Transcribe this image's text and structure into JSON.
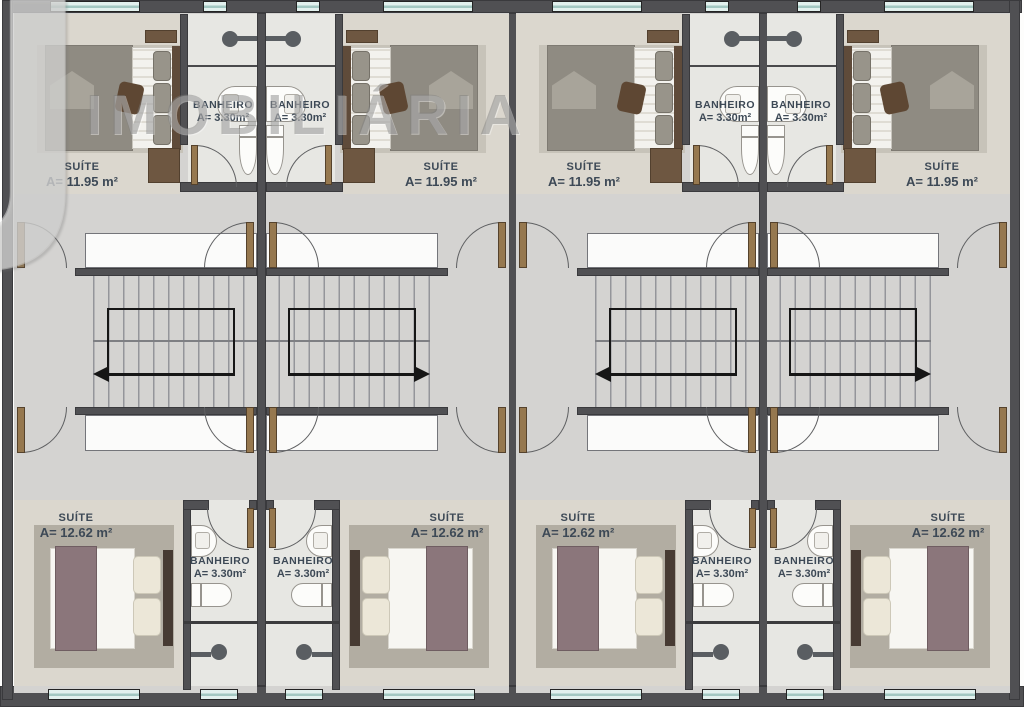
{
  "watermark": {
    "logo": "J",
    "brand": "IMOBILIÁRIA"
  },
  "rooms": {
    "suite_top": {
      "label": "SUÍTE",
      "area": "A= 11.95 m²"
    },
    "suite_bottom": {
      "label": "SUÍTE",
      "area": "A= 12.62 m²"
    },
    "bathroom": {
      "label": "BANHEIRO",
      "area": "A= 3.30m²"
    }
  },
  "units": [
    {
      "id": "unit-1",
      "mirrored": false,
      "stair_direction": "left"
    },
    {
      "id": "unit-2",
      "mirrored": true,
      "stair_direction": "right"
    },
    {
      "id": "unit-3",
      "mirrored": false,
      "stair_direction": "left"
    },
    {
      "id": "unit-4",
      "mirrored": true,
      "stair_direction": "right"
    }
  ],
  "colors": {
    "wall": "#505053",
    "wallEdge": "#3a3a3d",
    "floorHall": "#d4d3d1",
    "floorSuite": "#dbd7ce",
    "floorBath": "#e7e7e3",
    "voidFill": "#fbfbfa",
    "voidBorder": "#74757a",
    "windowGlass": "#e2f1ee",
    "windowMullion": "#a3c8c2",
    "windowFrame": "#242424",
    "door": "#96784f",
    "doorEdge": "#55422c",
    "arc": "#5e5f61",
    "tread": "#94959a",
    "rail": "#161616",
    "rugTop": "#c7c3b9",
    "duvetTop": "#8f8b82",
    "duvetFold": "#a8a49a",
    "sheet": "#f3f2ee",
    "sheetShade": "#dfdcd4",
    "pillowGray": "#98948a",
    "headboard": "#5f4b3a",
    "wood": "#6e5741",
    "accentPillow": "#5e4733",
    "rugBottom": "#b2ada2",
    "duvetBottom": "#8b767b",
    "pillowCream": "#ece7d8",
    "pillowCreamEdge": "#cdc8b8",
    "headboardB": "#473b33",
    "mattress": "#f7f6f2",
    "fixture": "#fcfcfa",
    "fixtureEdge": "#97948e",
    "shower": "#5a5e62",
    "labelText": "#3d4956",
    "watermarkText": "rgba(125,125,125,0.45)",
    "watermarkLogo": "rgba(214,214,212,0.55)"
  }
}
